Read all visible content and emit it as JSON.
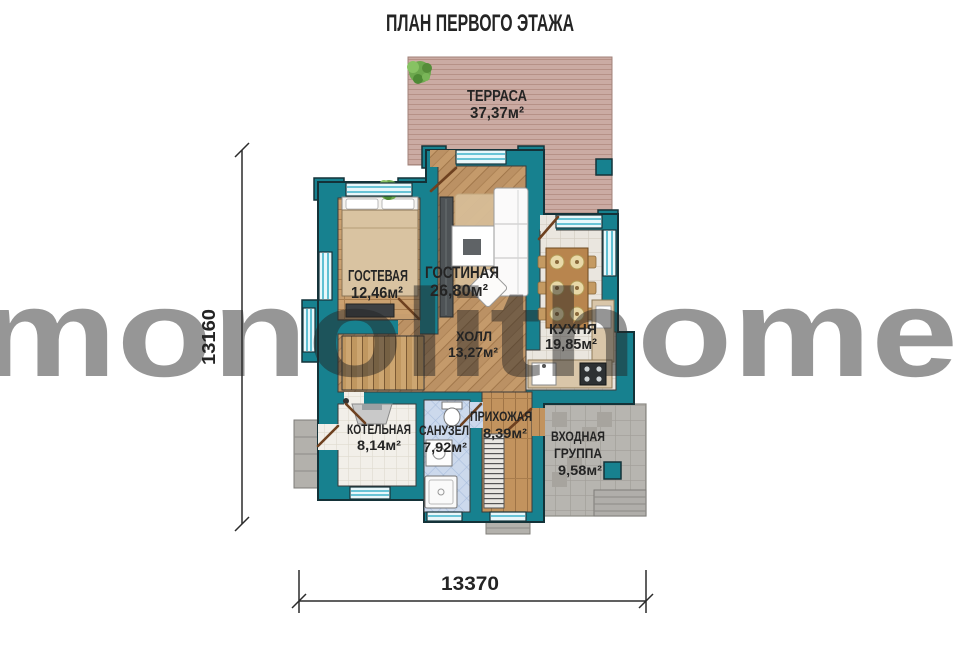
{
  "title": "ПЛАН ПЕРВОГО ЭТАЖА",
  "watermark": "monolithome",
  "rooms": {
    "terrace": {
      "name": "ТЕРРАСА",
      "area": "37,37м²"
    },
    "guest": {
      "name": "ГОСТЕВАЯ",
      "area": "12,46м²"
    },
    "living": {
      "name": "ГОСТИНАЯ",
      "area": "26,80м²"
    },
    "kitchen": {
      "name": "КУХНЯ",
      "area": "19,85м²"
    },
    "hall": {
      "name": "ХОЛЛ",
      "area": "13,27м²"
    },
    "boiler": {
      "name": "КОТЕЛЬНАЯ",
      "area": "8,14м²"
    },
    "bathroom": {
      "name": "САНУЗЕЛ",
      "area": "7,92м²"
    },
    "hallway": {
      "name": "ПРИХОЖАЯ",
      "area": "8,39м²"
    },
    "entrance": {
      "line1": "ВХОДНАЯ",
      "line2": "ГРУППА",
      "area": "9,58м²"
    }
  },
  "dimensions": {
    "height_label": "13160",
    "width_label": "13370"
  },
  "colors": {
    "wall": "#17818f",
    "terrace_deck": "#cbaba3",
    "wood": "#c49a6b",
    "window_glass": "#bfe7f0",
    "kitchen_tile": "#eae6df",
    "bath_tile": "#ccd9ec",
    "stone": "#b7b5b0"
  }
}
